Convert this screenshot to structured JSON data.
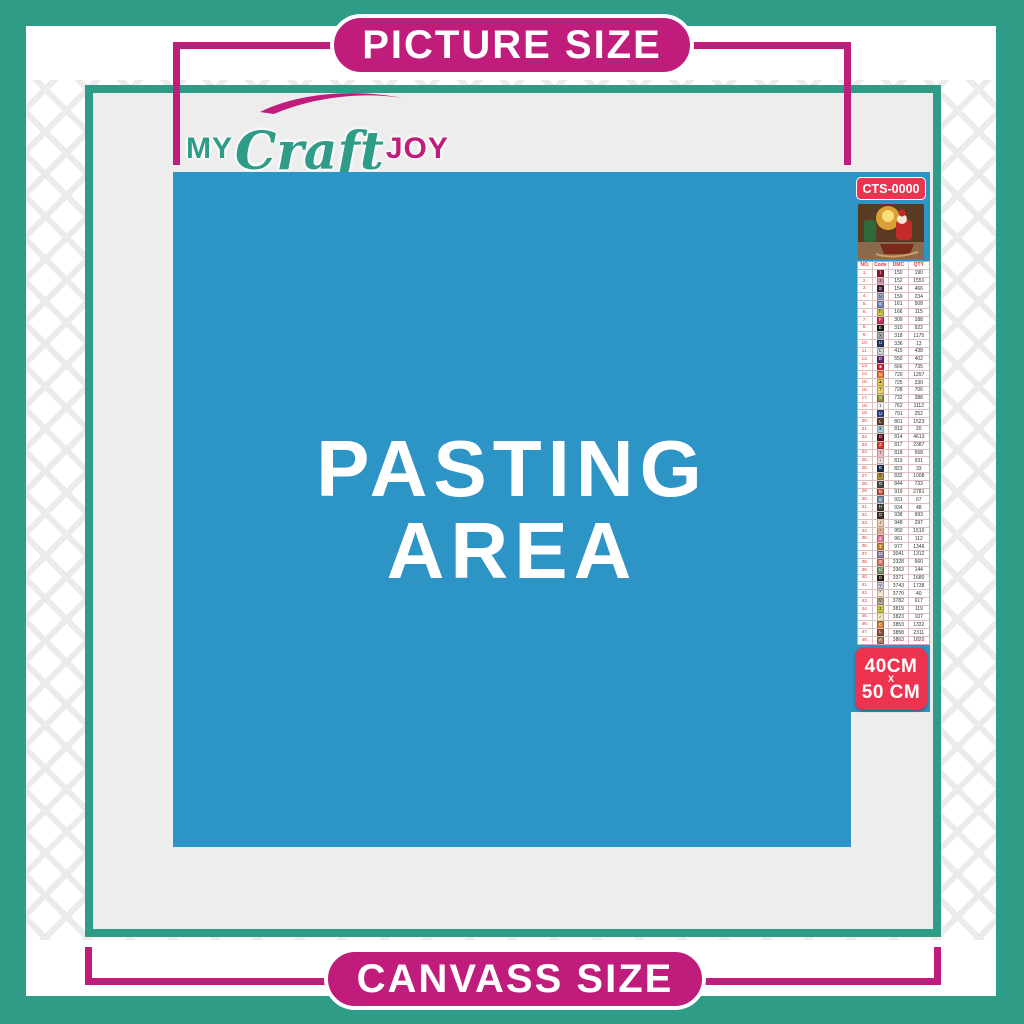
{
  "banners": {
    "top": {
      "label": "PICTURE SIZE"
    },
    "bottom": {
      "label": "CANVASS SIZE"
    }
  },
  "logo": {
    "part1": "MY",
    "part2": "Craft",
    "part3": "JOY"
  },
  "pasting_area": {
    "line1": "PASTING",
    "line2": "AREA"
  },
  "legend": {
    "sku": "CTS-0000",
    "size": {
      "line1": "40CM",
      "line2": "X",
      "line3": "50 CM"
    },
    "table": {
      "headers": [
        "NO.",
        "Code",
        "DMC",
        "QTY"
      ],
      "rows": [
        {
          "no": "1.",
          "symbol": "t",
          "color": "#8d1b30",
          "text": "#fff",
          "dmc": "150",
          "qty": "190"
        },
        {
          "no": "2.",
          "symbol": "3",
          "color": "#d695ac",
          "text": "#222",
          "dmc": "152",
          "qty": "1551"
        },
        {
          "no": "3.",
          "symbol": "S",
          "color": "#43253d",
          "text": "#fff",
          "dmc": "154",
          "qty": "466"
        },
        {
          "no": "4.",
          "symbol": "N",
          "color": "#a3aacb",
          "text": "#222",
          "dmc": "159",
          "qty": "234"
        },
        {
          "no": "5.",
          "symbol": "G",
          "color": "#7d88b2",
          "text": "#fff",
          "dmc": "161",
          "qty": "508"
        },
        {
          "no": "6.",
          "symbol": "h",
          "color": "#c9ca4e",
          "text": "#222",
          "dmc": "166",
          "qty": "115"
        },
        {
          "no": "7.",
          "symbol": "F",
          "color": "#c5355a",
          "text": "#fff",
          "dmc": "309",
          "qty": "188"
        },
        {
          "no": "8.",
          "symbol": "E",
          "color": "#1a1a1a",
          "text": "#fff",
          "dmc": "310",
          "qty": "922"
        },
        {
          "no": "9.",
          "symbol": "X",
          "color": "#abacb0",
          "text": "#222",
          "dmc": "318",
          "qty": "1175"
        },
        {
          "no": "10.",
          "symbol": "U",
          "color": "#253760",
          "text": "#fff",
          "dmc": "336",
          "qty": "13"
        },
        {
          "no": "11.",
          "symbol": "L",
          "color": "#d2d3d6",
          "text": "#222",
          "dmc": "415",
          "qty": "438"
        },
        {
          "no": "12.",
          "symbol": "D",
          "color": "#5d2a6b",
          "text": "#fff",
          "dmc": "550",
          "qty": "402"
        },
        {
          "no": "13.",
          "symbol": "■",
          "color": "#cc2136",
          "text": "#fff",
          "dmc": "666",
          "qty": "735"
        },
        {
          "no": "14.",
          "symbol": "N",
          "color": "#e4732e",
          "text": "#fff",
          "dmc": "720",
          "qty": "1297"
        },
        {
          "no": "15.",
          "symbol": "▲",
          "color": "#f2c849",
          "text": "#222",
          "dmc": "725",
          "qty": "330"
        },
        {
          "no": "16.",
          "symbol": "7",
          "color": "#f5d35e",
          "text": "#222",
          "dmc": "728",
          "qty": "706"
        },
        {
          "no": "17.",
          "symbol": "S",
          "color": "#93903f",
          "text": "#fff",
          "dmc": "732",
          "qty": "388"
        },
        {
          "no": "18.",
          "symbol": "1",
          "color": "#f5f5f5",
          "text": "#222",
          "dmc": "762",
          "qty": "1112"
        },
        {
          "no": "19.",
          "symbol": "U",
          "color": "#2e4183",
          "text": "#fff",
          "dmc": "791",
          "qty": "252"
        },
        {
          "no": "20.",
          "symbol": "L",
          "color": "#63402a",
          "text": "#fff",
          "dmc": "801",
          "qty": "1523"
        },
        {
          "no": "21.",
          "symbol": "⊕",
          "color": "#abd0e4",
          "text": "#222",
          "dmc": "813",
          "qty": "20"
        },
        {
          "no": "22.",
          "symbol": "O",
          "color": "#621223",
          "text": "#fff",
          "dmc": "814",
          "qty": "4613"
        },
        {
          "no": "23.",
          "symbol": "Z",
          "color": "#d43f2d",
          "text": "#fff",
          "dmc": "817",
          "qty": "2387"
        },
        {
          "no": "24.",
          "symbol": "7",
          "color": "#f0bac9",
          "text": "#222",
          "dmc": "818",
          "qty": "568"
        },
        {
          "no": "25.",
          "symbol": "+",
          "color": "#f7dade",
          "text": "#222",
          "dmc": "819",
          "qty": "931"
        },
        {
          "no": "26.",
          "symbol": "B",
          "color": "#202e58",
          "text": "#fff",
          "dmc": "823",
          "qty": "33"
        },
        {
          "no": "27.",
          "symbol": "8",
          "color": "#b3923f",
          "text": "#222",
          "dmc": "832",
          "qty": "1008"
        },
        {
          "no": "28.",
          "symbol": "O",
          "color": "#4c4c49",
          "text": "#fff",
          "dmc": "844",
          "qty": "733"
        },
        {
          "no": "29.",
          "symbol": "M",
          "color": "#b84e2a",
          "text": "#fff",
          "dmc": "919",
          "qty": "2781"
        },
        {
          "no": "30.",
          "symbol": "5",
          "color": "#7390ab",
          "text": "#fff",
          "dmc": "931",
          "qty": "67"
        },
        {
          "no": "31.",
          "symbol": "H",
          "color": "#40442f",
          "text": "#fff",
          "dmc": "934",
          "qty": "48"
        },
        {
          "no": "32.",
          "symbol": "O",
          "color": "#4a3322",
          "text": "#fff",
          "dmc": "938",
          "qty": "993"
        },
        {
          "no": "33.",
          "symbol": "J",
          "color": "#f4d1bb",
          "text": "#222",
          "dmc": "948",
          "qty": "297"
        },
        {
          "no": "34.",
          "symbol": "*",
          "color": "#e2ad90",
          "text": "#222",
          "dmc": "950",
          "qty": "1510"
        },
        {
          "no": "35.",
          "symbol": "4",
          "color": "#e27a95",
          "text": "#fff",
          "dmc": "961",
          "qty": "112"
        },
        {
          "no": "36.",
          "symbol": "T",
          "color": "#cb8a31",
          "text": "#fff",
          "dmc": "977",
          "qty": "1346"
        },
        {
          "no": "37.",
          "symbol": "12",
          "color": "#927da0",
          "text": "#fff",
          "dmc": "3041",
          "qty": "1312"
        },
        {
          "no": "38.",
          "symbol": "9",
          "color": "#dc7a64",
          "text": "#fff",
          "dmc": "3328",
          "qty": "660"
        },
        {
          "no": "39.",
          "symbol": "U",
          "color": "#74906a",
          "text": "#fff",
          "dmc": "3363",
          "qty": "144"
        },
        {
          "no": "40.",
          "symbol": "O",
          "color": "#2d1f13",
          "text": "#fff",
          "dmc": "3371",
          "qty": "1680"
        },
        {
          "no": "41.",
          "symbol": "Y",
          "color": "#ccc7e0",
          "text": "#222",
          "dmc": "3743",
          "qty": "1738"
        },
        {
          "no": "42.",
          "symbol": "^",
          "color": "#f8e7d3",
          "text": "#222",
          "dmc": "3770",
          "qty": "40"
        },
        {
          "no": "43.",
          "symbol": "V",
          "color": "#b9a48c",
          "text": "#222",
          "dmc": "3782",
          "qty": "617"
        },
        {
          "no": "44.",
          "symbol": "2",
          "color": "#cdc63e",
          "text": "#222",
          "dmc": "3819",
          "qty": "119"
        },
        {
          "no": "45.",
          "symbol": "✓",
          "color": "#f3e6b8",
          "text": "#222",
          "dmc": "3823",
          "qty": "107"
        },
        {
          "no": "46.",
          "symbol": "C",
          "color": "#d3803d",
          "text": "#fff",
          "dmc": "3853",
          "qty": "1332"
        },
        {
          "no": "47.",
          "symbol": "L",
          "color": "#8f4e3f",
          "text": "#fff",
          "dmc": "3858",
          "qty": "2311"
        },
        {
          "no": "48.",
          "symbol": "A",
          "color": "#a07e61",
          "text": "#fff",
          "dmc": "3863",
          "qty": "1820"
        }
      ]
    }
  },
  "colors": {
    "teal": "#2f9c87",
    "magenta": "#c01c7b",
    "blue": "#2d94c6",
    "red": "#ee3350",
    "canvas": "#ededed"
  }
}
